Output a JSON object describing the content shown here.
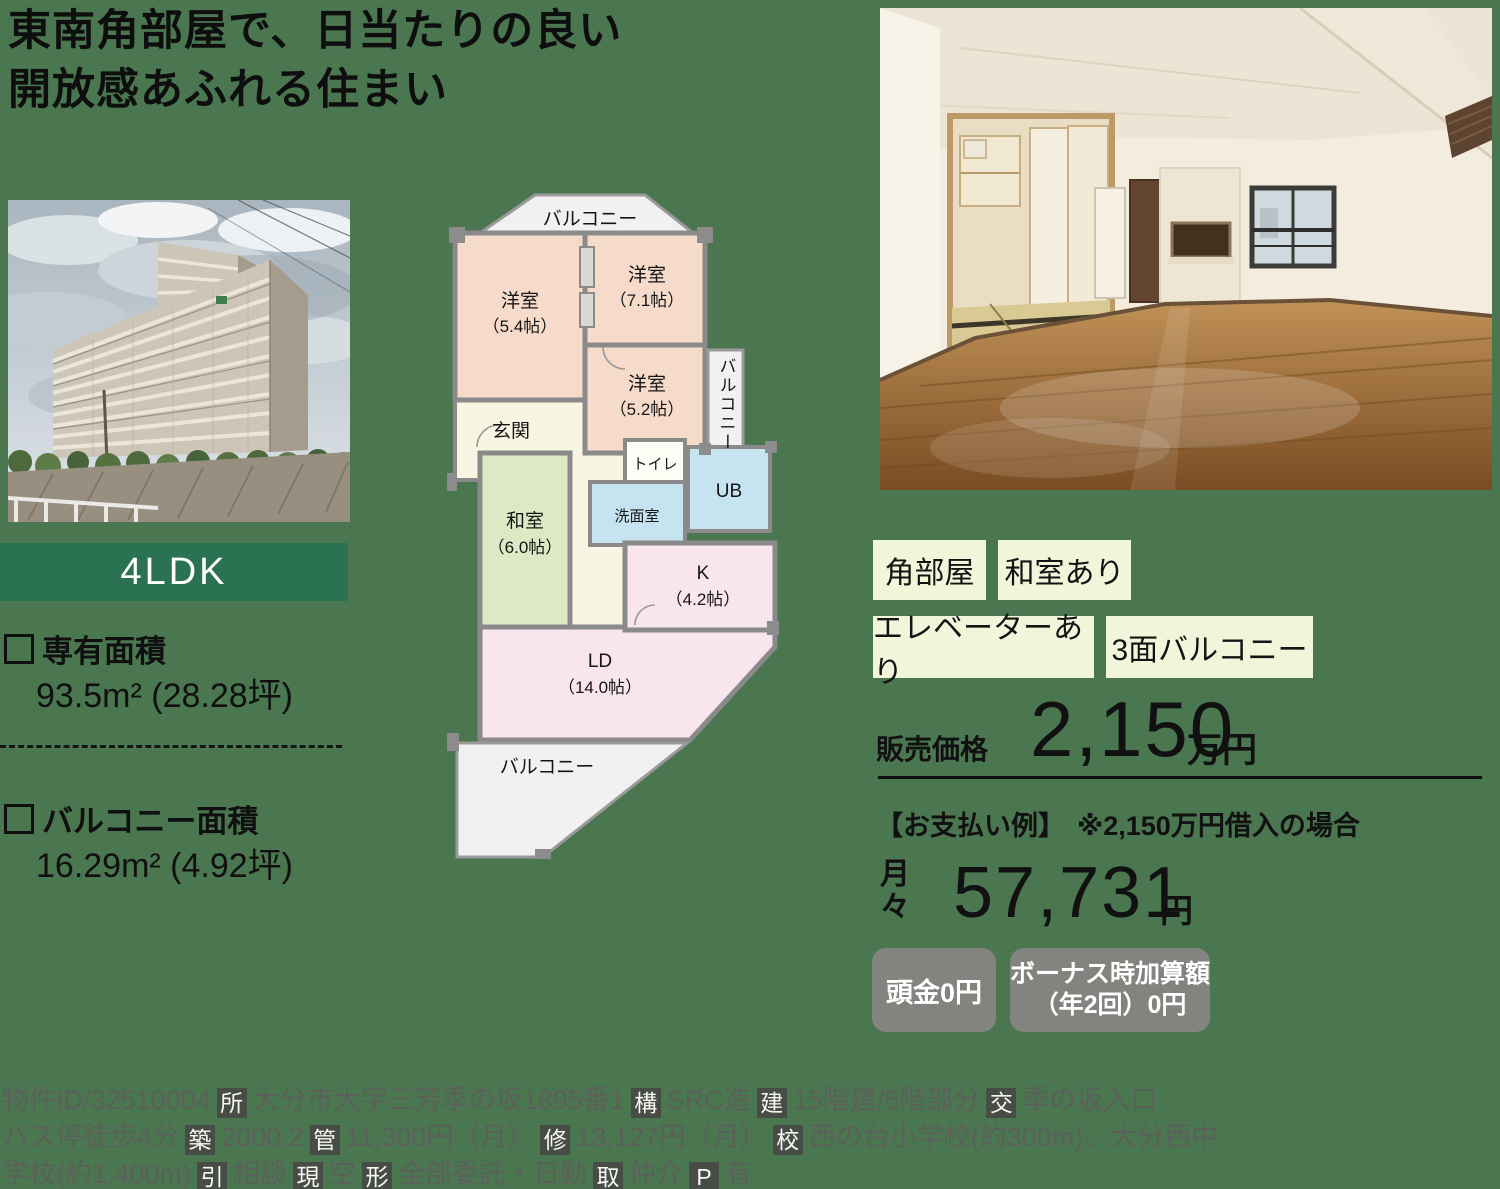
{
  "headline": {
    "line1": "東南角部屋で、日当たりの良い",
    "line2": "開放感あふれる住まい"
  },
  "layout_type": "4LDK",
  "areas": {
    "exclusive_label": "専有面積",
    "exclusive_value": "93.5m² (28.28坪)",
    "balcony_label": "バルコニー面積",
    "balcony_value": "16.29m² (4.92坪)"
  },
  "floorplan": {
    "balcony_top": "バルコニー",
    "balcony_right": "バルコニー",
    "balcony_bottom": "バルコニー",
    "bed1": {
      "name": "洋室",
      "size": "（5.4帖）"
    },
    "bed2": {
      "name": "洋室",
      "size": "（7.1帖）"
    },
    "bed3": {
      "name": "洋室",
      "size": "（5.2帖）"
    },
    "entrance": "玄関",
    "toilet": "トイレ",
    "washroom": "洗面室",
    "bath": "UB",
    "tatami": {
      "name": "和室",
      "size": "（6.0帖）"
    },
    "kitchen": {
      "name": "K",
      "size": "（4.2帖）"
    },
    "living": {
      "name": "LD",
      "size": "（14.0帖）"
    }
  },
  "tags": [
    "角部屋",
    "和室あり",
    "エレベーターあり",
    "3面バルコニー"
  ],
  "price": {
    "label": "販売価格",
    "amount": "2,150",
    "unit": "万円"
  },
  "payment": {
    "header": "【お支払い例】",
    "note": "※2,150万円借入の場合",
    "monthly_char1": "月",
    "monthly_char2": "々",
    "amount": "57,731",
    "unit": "円",
    "badge1": "頭金0円",
    "badge2_line1": "ボーナス時加算額",
    "badge2_line2": "（年2回）0円"
  },
  "fineprint": {
    "lines": [
      [
        {
          "v": "物件ID/32510004"
        },
        {
          "v": "所",
          "b": true
        },
        {
          "v": "大分市大字三芳季の坂1895番1"
        },
        {
          "v": "構",
          "b": true
        },
        {
          "v": "SRC造"
        },
        {
          "v": "建",
          "b": true
        },
        {
          "v": "15階建/6階部分"
        },
        {
          "v": "交",
          "b": true
        },
        {
          "v": "季の坂入口"
        }
      ],
      [
        {
          "v": "バス停徒歩4分"
        },
        {
          "v": "築",
          "b": true
        },
        {
          "v": "2000.2"
        },
        {
          "v": "管",
          "b": true
        },
        {
          "v": "11,300円（月）"
        },
        {
          "v": "修",
          "b": true
        },
        {
          "v": "13,127円（月）"
        },
        {
          "v": "校",
          "b": true
        },
        {
          "v": "西の台小学校(約300m)、大分西中"
        }
      ],
      [
        {
          "v": "学校(約1,400m)"
        },
        {
          "v": "引",
          "b": true
        },
        {
          "v": "相談"
        },
        {
          "v": "現",
          "b": true
        },
        {
          "v": "空"
        },
        {
          "v": "形",
          "b": true
        },
        {
          "v": "全部委託・日勤"
        },
        {
          "v": "取",
          "b": true
        },
        {
          "v": "仲介"
        },
        {
          "v": "P",
          "b": true
        },
        {
          "v": "有"
        }
      ]
    ]
  },
  "colors": {
    "page_background": "#4a7750",
    "type_badge_green": "#2a7252",
    "tag_background": "#f1f5d9",
    "gray_badge": "#83837f",
    "plan_bedroom": "#f7dbca",
    "plan_tatami": "#dde9c5",
    "plan_wet": "#c5e4f0",
    "plan_ld": "#f8e5ee",
    "plan_hall": "#f8f5e2"
  }
}
